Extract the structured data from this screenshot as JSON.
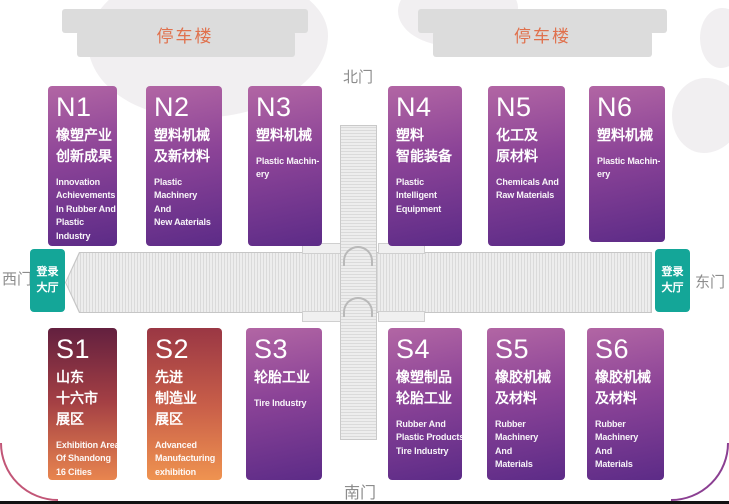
{
  "parking": {
    "left_label": "停车楼",
    "right_label": "停车楼"
  },
  "gates": {
    "north": "北门",
    "south": "南门",
    "west": "西门",
    "east": "东门"
  },
  "registration": {
    "west_label": "登录\n大厅",
    "east_label": "登录\n大厅"
  },
  "halls": [
    {
      "code": "N1",
      "cn": "橡塑产业\n创新成果",
      "en": "Innovation\nAchievements\nIn Rubber And\nPlastic\nIndustry"
    },
    {
      "code": "N2",
      "cn": "塑料机械\n及新材料",
      "en": "Plastic\nMachinery\nAnd\nNew Aaterials"
    },
    {
      "code": "N3",
      "cn": "塑料机械",
      "en": "Plastic Machin-\nery"
    },
    {
      "code": "N4",
      "cn": "塑料\n智能装备",
      "en": "Plastic\nIntelligent\nEquipment"
    },
    {
      "code": "N5",
      "cn": "化工及\n原材料",
      "en": "Chemicals And\nRaw Materials"
    },
    {
      "code": "N6",
      "cn": "塑料机械",
      "en": "Plastic Machin-\nery"
    },
    {
      "code": "S1",
      "cn": "山东\n十六市\n展区",
      "en": "Exhibition Area\nOf Shandong\n16 Cities"
    },
    {
      "code": "S2",
      "cn": "先进\n制造业\n展区",
      "en": "Advanced\nManufacturing\nexhibition\narea"
    },
    {
      "code": "S3",
      "cn": "轮胎工业",
      "en": "Tire Industry"
    },
    {
      "code": "S4",
      "cn": "橡塑制品\n轮胎工业",
      "en": "Rubber And\nPlastic Products\nTire Industry"
    },
    {
      "code": "S5",
      "cn": "橡胶机械\n及材料",
      "en": "Rubber\nMachinery\nAnd\nMaterials"
    },
    {
      "code": "S6",
      "cn": "橡胶机械\n及材料",
      "en": "Rubber\nMachinery\nAnd\nMaterials"
    }
  ],
  "colors": {
    "hall_purple_top": "#b266a4",
    "hall_purple_bottom": "#5c2b87",
    "s1_gradient_top": "#63203f",
    "s1_gradient_bottom": "#e8854f",
    "s2_gradient_top": "#9a3744",
    "s2_gradient_bottom": "#ef9350",
    "registration_teal": "#14a698",
    "parking_gray": "#dcdcdc",
    "parking_text": "#e0714d",
    "gate_text": "#8c8c8c"
  }
}
